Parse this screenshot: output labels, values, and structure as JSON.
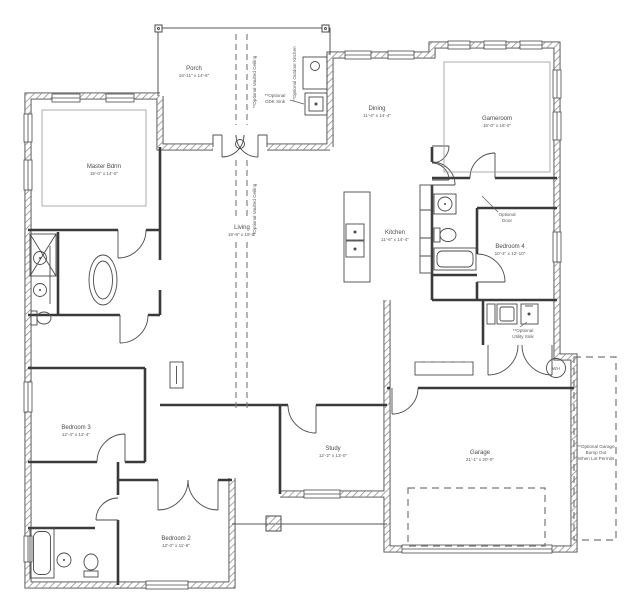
{
  "colors": {
    "wall_edge": "#4a4a4a",
    "wall_hatch": "#909090",
    "interior_wall": "#3a3a3a",
    "dashed_line": "#777777",
    "label_text": "#4a4a4a",
    "background": "#ffffff"
  },
  "rooms": {
    "porch": {
      "name": "Porch",
      "dims": "16'-11\" x 14'-6\""
    },
    "master": {
      "name": "Master Bdrm",
      "dims": "15'-0\" x 14'-0\""
    },
    "dining": {
      "name": "Dining",
      "dims": "11'-4\" x 14'-4\""
    },
    "gameroom": {
      "name": "Gameroom",
      "dims": "16'-0\" x 16'-0\""
    },
    "kitchen": {
      "name": "Kitchen",
      "dims": "11'-6\" x 14'-4\""
    },
    "bedroom4": {
      "name": "Bedroom 4",
      "dims": "10'-4\" x 12'-10\""
    },
    "living": {
      "name": "Living",
      "dims": "19'-8\" x 19'-0\""
    },
    "study": {
      "name": "Study",
      "dims": "12'-2\" x 13'-0\""
    },
    "bedroom3": {
      "name": "Bedroom 3",
      "dims": "12'-4\" x 12'-4\""
    },
    "bedroom2": {
      "name": "Bedroom 2",
      "dims": "12'-0\" x 11'-6\""
    },
    "garage": {
      "name": "Garage",
      "dims": "21'-1\" x 20'-0\""
    }
  },
  "annotations": {
    "vaulted_porch": {
      "text": "**Optional Vaulted Ceiling"
    },
    "vaulted_living": {
      "text": "**Optional Vaulted Ceiling"
    },
    "outdoor_kitchen": {
      "text": "**Optional Outdoor Kitchen"
    },
    "odk_sink": {
      "line1": "**Optional",
      "line2": "ODK Sink"
    },
    "optional_door": {
      "line1": "Optional",
      "line2": "Door"
    },
    "utility_sink": {
      "line1": "**Optional",
      "line2": "Utility Sink"
    },
    "garage_bump": {
      "line1": "**Optional Garage",
      "line2": "Bump Out",
      "line3": "When Lot Permits"
    },
    "water_heater": {
      "text": "WH"
    }
  }
}
